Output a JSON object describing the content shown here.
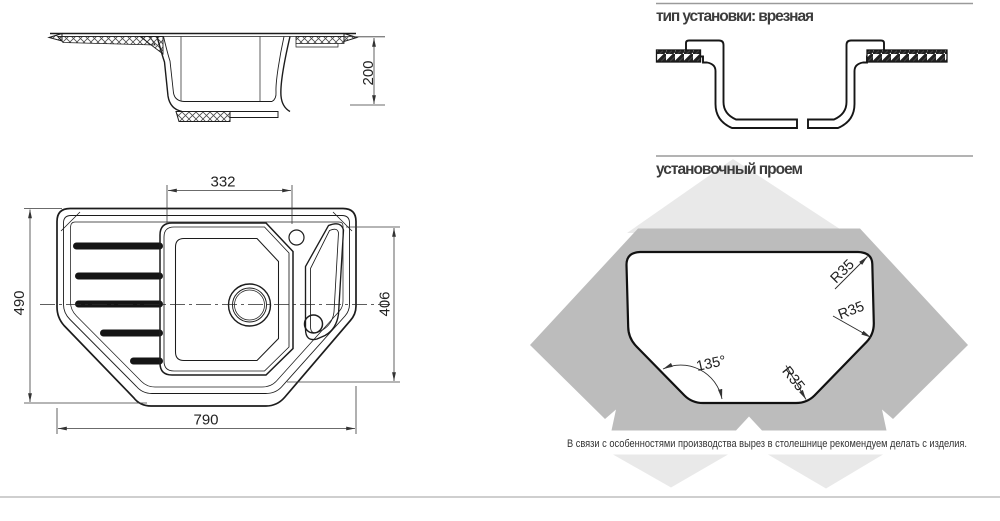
{
  "side_view": {
    "depth_dim": "200"
  },
  "top_view": {
    "bowl_width_dim": "332",
    "overall_width_dim": "790",
    "overall_depth_dim": "490",
    "inner_depth_dim": "406"
  },
  "installation_type": {
    "title": "тип установки: врезная"
  },
  "cutout_section": {
    "title": "установочный проем",
    "radius_top_right": "R35",
    "radius_right": "R35",
    "radius_bottom": "R35",
    "corner_angle": "135°",
    "note": "В связи с особенностями производства вырез в столешнице рекомендуем делать с изделия."
  },
  "colors": {
    "line": "#1c1c1c",
    "dim_line": "#3a3a3a",
    "rule": "#9a9a9a",
    "watermark_dark": "#bcbcbc",
    "watermark_light": "#e9e9e9",
    "text": "#3c3c3c"
  }
}
